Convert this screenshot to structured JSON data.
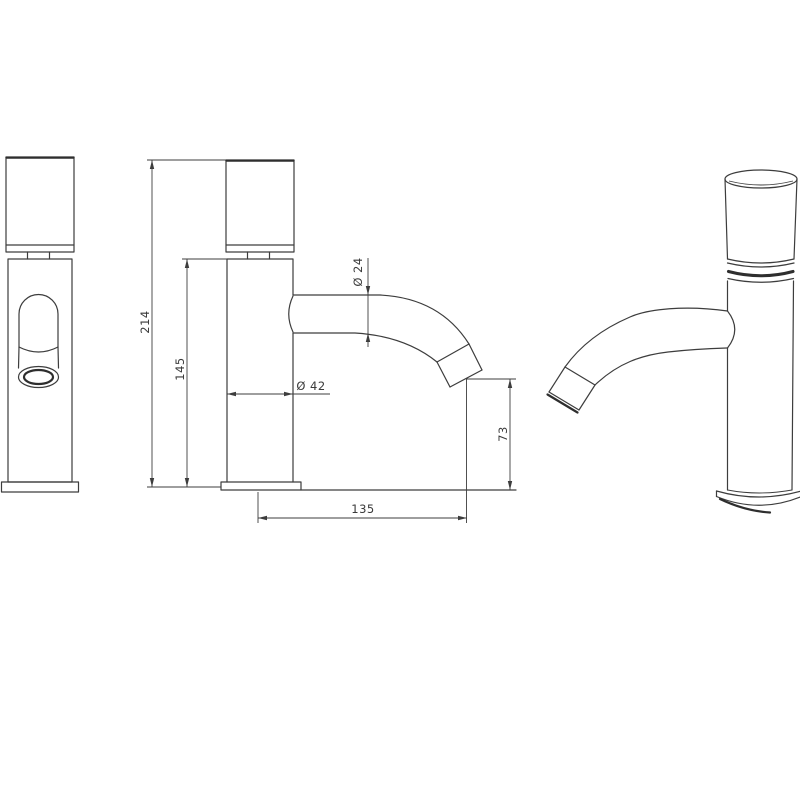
{
  "drawing": {
    "subject": "washbasin tap (faucet) technical dimension drawing, three views",
    "background_color": "#ffffff",
    "line_color": "#3d3d3d",
    "dimensions": {
      "overall_height": {
        "label": "214",
        "orientation": "vertical"
      },
      "body_height": {
        "label": "145",
        "orientation": "vertical"
      },
      "spout_diameter": {
        "label": "Ø 24",
        "orientation": "vertical-rotated"
      },
      "body_diameter": {
        "label": "Ø 42",
        "orientation": "horizontal"
      },
      "outlet_height": {
        "label": "73",
        "orientation": "vertical"
      },
      "spout_reach": {
        "label": "135",
        "orientation": "horizontal"
      }
    }
  }
}
